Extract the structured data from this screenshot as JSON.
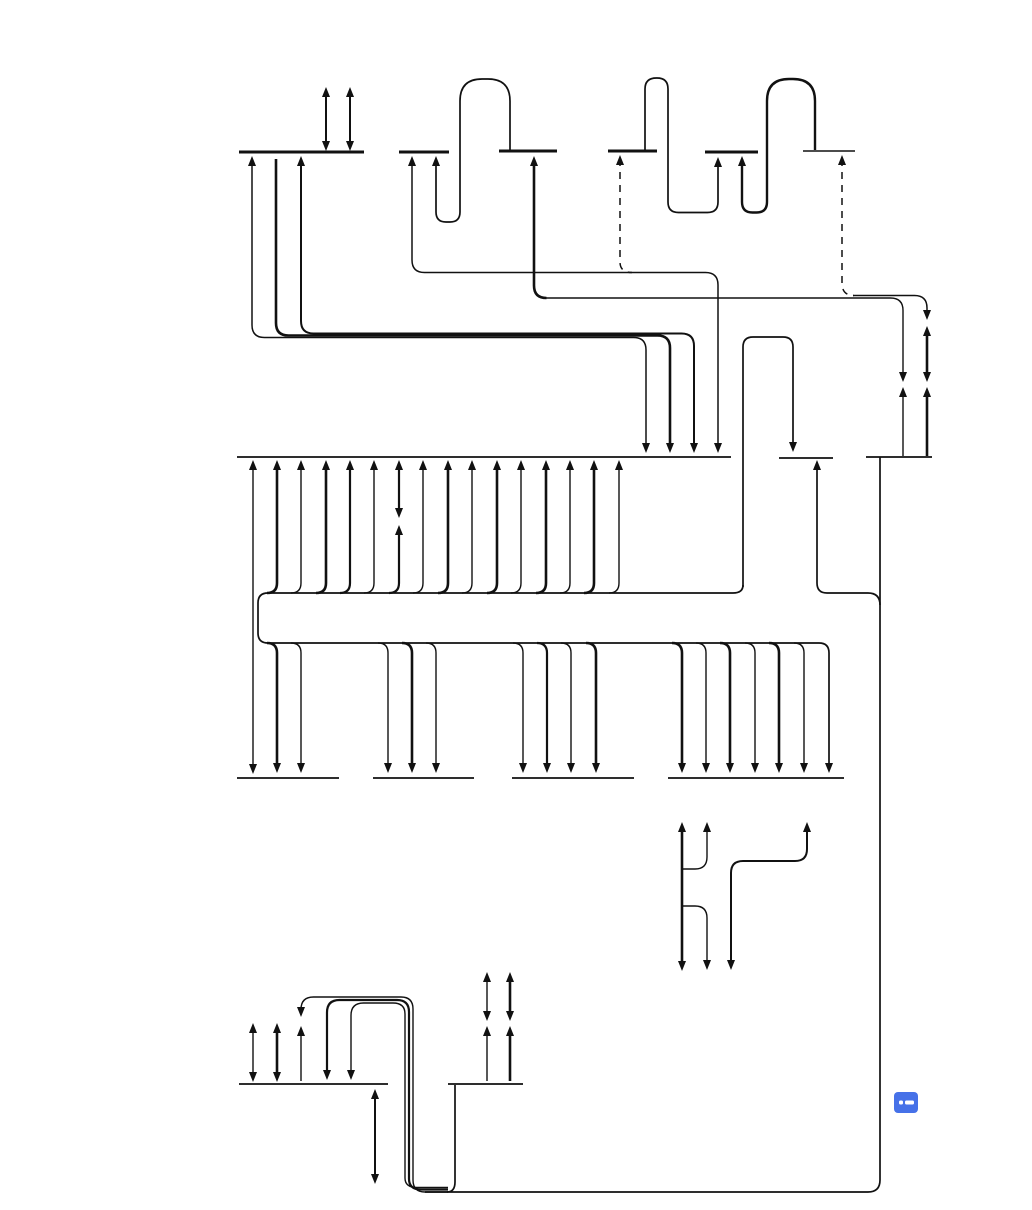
{
  "canvas": {
    "width": 1032,
    "height": 1210,
    "background": "#ffffff",
    "line_color": "#111111"
  },
  "marker_icon": {
    "name": "comment-marker-icon",
    "x": 894,
    "y": 1092,
    "width": 24,
    "height": 21,
    "radius": 4,
    "color": "#4671e8",
    "glyph_color": "#ffffff",
    "dot": {
      "x": 5,
      "y": 8.5,
      "w": 4,
      "h": 4
    },
    "dash": {
      "x": 11,
      "y": 8.5,
      "w": 9,
      "h": 4
    }
  },
  "buses": [
    {
      "id": "top-bus-a",
      "x1": 239,
      "x2": 364,
      "y": 152,
      "w": 3
    },
    {
      "id": "top-bus-b",
      "x1": 399,
      "x2": 449,
      "y": 152,
      "w": 3
    },
    {
      "id": "top-bus-b2",
      "x1": 499,
      "x2": 557,
      "y": 151,
      "w": 3
    },
    {
      "id": "top-bus-c",
      "x1": 608,
      "x2": 657,
      "y": 151,
      "w": 3
    },
    {
      "id": "top-bus-d",
      "x1": 705,
      "x2": 758,
      "y": 152,
      "w": 3
    },
    {
      "id": "top-bus-e",
      "x1": 803,
      "x2": 855,
      "y": 151,
      "w": 1.6
    },
    {
      "id": "mid-bus-1",
      "x1": 237,
      "x2": 731,
      "y": 457,
      "w": 1.7
    },
    {
      "id": "mid-bus-2",
      "x1": 779,
      "x2": 833,
      "y": 458,
      "w": 1.7
    },
    {
      "id": "mid-bus-3",
      "x1": 866,
      "x2": 932,
      "y": 457,
      "w": 1.7
    },
    {
      "id": "low-bus-1",
      "x1": 237,
      "x2": 339,
      "y": 778,
      "w": 1.7
    },
    {
      "id": "low-bus-2",
      "x1": 373,
      "x2": 474,
      "y": 778,
      "w": 1.7
    },
    {
      "id": "low-bus-3",
      "x1": 512,
      "x2": 634,
      "y": 778,
      "w": 1.7
    },
    {
      "id": "low-bus-4",
      "x1": 668,
      "x2": 844,
      "y": 778,
      "w": 1.7
    },
    {
      "id": "bottom-bus-1",
      "x1": 239,
      "x2": 388,
      "y": 1084,
      "w": 1.7
    },
    {
      "id": "bottom-bus-2",
      "x1": 448,
      "x2": 523,
      "y": 1084,
      "w": 1.7
    }
  ],
  "paths": [
    {
      "d": "M 326 96 V 143",
      "w": 2
    },
    {
      "d": "M 350 96 V 143",
      "w": 2
    },
    {
      "d": "M 252 160 V 325 Q 252 337.5 264.5 337.5 H 633.5 Q 646 337.5 646 350 V 448",
      "w": 1.5
    },
    {
      "d": "M 276 159 V 323 Q 276 335.5 288.5 335.5 H 657.5 Q 670 335.5 670 348 V 448",
      "w": 2.6
    },
    {
      "d": "M 301 160 V 321 Q 301 333.5 313.5 333.5 H 681.5 Q 694 333.5 694 346 V 448",
      "w": 2
    },
    {
      "d": "M 412 160 V 260 Q 412 272.5 424.5 272.5 H 705.5 Q 718 272.5 718 285 V 448",
      "w": 1.5
    },
    {
      "d": "M 620 159 V 262 Q 620 272.5 632 272.5",
      "w": 1.5,
      "dash": "7 6"
    },
    {
      "d": "M 534 160 V 285.5 Q 534 298 546.5 298",
      "w": 2.6
    },
    {
      "d": "M 545 298 H 890.5 Q 903 298 903 310.5 V 377",
      "w": 1.4
    },
    {
      "d": "M 903 391 V 456",
      "w": 1.4
    },
    {
      "d": "M 842 159 V 283 Q 842 295.5 854 295.5",
      "w": 1.5,
      "dash": "7 6"
    },
    {
      "d": "M 853 295.5 H 914.5 Q 927 295.5 927 308 V 314",
      "w": 1.5
    },
    {
      "d": "M 927 331 V 377",
      "w": 2.6
    },
    {
      "d": "M 927 391 V 456",
      "w": 2.6
    },
    {
      "d": "M 436 159 V 212 Q 436 222 446 222 H 450 Q 460 222 460 212 V 101 Q 460 79 482 79 H 488 Q 510 79 510 101 V 150",
      "w": 1.7
    },
    {
      "d": "M 645 151 V 89 Q 645 78 656.5 78 H 657 Q 668 78 668 89 V 202 Q 668 212.5 678.5 212.5 H 707.5 Q 718 212.5 718 202 V 161",
      "w": 1.7
    },
    {
      "d": "M 742 159 V 202 Q 742 212.5 752.5 212.5 H 756.5 Q 767 212.5 767 202 V 101 Q 767 79 789 79 H 793 Q 815 79 815 101 V 150",
      "w": 2.4
    },
    {
      "d": "M 253 463 V 771",
      "w": 1.4
    },
    {
      "d": "M 267 593 Q 277 593 277 583 V 464",
      "w": 2.6
    },
    {
      "d": "M 291 593 Q 301 593 301 583 V 464",
      "w": 1.4
    },
    {
      "d": "M 316 593 Q 326 593 326 583 V 464",
      "w": 2.6
    },
    {
      "d": "M 340 593 Q 350 593 350 583 V 464",
      "w": 2.2
    },
    {
      "d": "M 364 593 Q 374 593 374 583 V 464",
      "w": 1.4
    },
    {
      "d": "M 389 593 Q 399 593 399 583 V 529",
      "w": 2.2
    },
    {
      "d": "M 399 514 V 464",
      "w": 2.2
    },
    {
      "d": "M 413 593 Q 423 593 423 583 V 464",
      "w": 1.4
    },
    {
      "d": "M 438 593 Q 448 593 448 583 V 464",
      "w": 2.6
    },
    {
      "d": "M 462 593 Q 472 593 472 583 V 464",
      "w": 1.4
    },
    {
      "d": "M 487 593 Q 497 593 497 583 V 464",
      "w": 2.6
    },
    {
      "d": "M 511 593 Q 521 593 521 583 V 464",
      "w": 1.4
    },
    {
      "d": "M 536 593 Q 546 593 546 583 V 464",
      "w": 2.6
    },
    {
      "d": "M 560 593 Q 570 593 570 583 V 464",
      "w": 1.4
    },
    {
      "d": "M 584 593 Q 594 593 594 583 V 464",
      "w": 2.6
    },
    {
      "d": "M 609 593 Q 619 593 619 583 V 464",
      "w": 1.4
    },
    {
      "d": "M 743 585 Q 743 593 733 593 H 268 Q 258 593 258 603 V 633 Q 258 643 268 643 H 819 Q 829 643 829 653 V 766",
      "w": 1.7
    },
    {
      "d": "M 743 587 V 347 Q 743 337 753 337 H 783 Q 793 337 793 347 V 448",
      "w": 1.7
    },
    {
      "d": "M 817 463 V 583 Q 817 593 827 593 H 868 Q 880 593 880 605",
      "w": 1.7
    },
    {
      "d": "M 880 457 V 1180 Q 880 1192 868 1192 H 425",
      "w": 1.7
    },
    {
      "d": "M 267 643 Q 277 643 277 653 V 766",
      "w": 2.6
    },
    {
      "d": "M 291 643 Q 301 643 301 653 V 766",
      "w": 1.4
    },
    {
      "d": "M 378 643 Q 388 643 388 653 V 766",
      "w": 1.4
    },
    {
      "d": "M 402 643 Q 412 643 412 653 V 766",
      "w": 2.6
    },
    {
      "d": "M 426 643 Q 436 643 436 653 V 766",
      "w": 1.4
    },
    {
      "d": "M 513 643 Q 523 643 523 653 V 766",
      "w": 1.4
    },
    {
      "d": "M 537 643 Q 547 643 547 653 V 766",
      "w": 2.2
    },
    {
      "d": "M 561 643 Q 571 643 571 653 V 766",
      "w": 1.4
    },
    {
      "d": "M 586 643 Q 596 643 596 653 V 766",
      "w": 2.6
    },
    {
      "d": "M 672 643 Q 682 643 682 653 V 766",
      "w": 2.6
    },
    {
      "d": "M 696 643 Q 706 643 706 653 V 766",
      "w": 1.4
    },
    {
      "d": "M 720 643 Q 730 643 730 653 V 766",
      "w": 2.6
    },
    {
      "d": "M 745 643 Q 755 643 755 653 V 766",
      "w": 1.4
    },
    {
      "d": "M 769 643 Q 779 643 779 653 V 766",
      "w": 2.6
    },
    {
      "d": "M 794 643 Q 804 643 804 653 V 766",
      "w": 1.4
    },
    {
      "d": "M 682 826 V 967",
      "w": 2.6
    },
    {
      "d": "M 707 826 V 857 Q 707 869 695 869 H 682",
      "w": 1.4
    },
    {
      "d": "M 682 906 H 695 Q 707 906 707 918 V 964",
      "w": 1.4
    },
    {
      "d": "M 731 966 V 873 Q 731 861 743 861 H 795 Q 807 861 807 849 V 826",
      "w": 2
    },
    {
      "d": "M 253 1027 V 1078",
      "w": 1.4
    },
    {
      "d": "M 277 1027 V 1078",
      "w": 2.6
    },
    {
      "d": "M 301 1013 V 1009.5 Q 301 997 313.5 997 H 401 Q 413 997 413 1009 V 1180 Q 413 1192 425 1192 H 448",
      "w": 1.4
    },
    {
      "d": "M 327 1074 V 1012.5 Q 327 1000 339.5 1000 H 397 Q 409 1000 409 1012 V 1179 Q 409 1189.5 421 1189.5 H 448",
      "w": 2.2
    },
    {
      "d": "M 351 1074 V 1015.5 Q 351 1003 363.5 1003 H 393 Q 405 1003 405 1014 V 1178 Q 405 1187.5 417 1187.5 H 448",
      "w": 1.4
    },
    {
      "d": "M 447 1192 Q 455 1192 455 1182 V 1085",
      "w": 1.7
    },
    {
      "d": "M 375 1098 V 1179",
      "w": 2
    },
    {
      "d": "M 487 1081 V 1030",
      "w": 1.4
    },
    {
      "d": "M 487 1017 V 976",
      "w": 1.4
    },
    {
      "d": "M 510 1081 V 1030",
      "w": 2.6
    },
    {
      "d": "M 510 1017 V 976",
      "w": 2.6
    },
    {
      "d": "M 301 1081 V 1030",
      "w": 1.4
    }
  ],
  "arrowheads": [
    {
      "x": 326,
      "y": 87,
      "dir": "u"
    },
    {
      "x": 326,
      "y": 151,
      "dir": "d"
    },
    {
      "x": 350,
      "y": 87,
      "dir": "u"
    },
    {
      "x": 350,
      "y": 151,
      "dir": "d"
    },
    {
      "x": 252,
      "y": 156,
      "dir": "u"
    },
    {
      "x": 646,
      "y": 453,
      "dir": "d"
    },
    {
      "x": 670,
      "y": 453,
      "dir": "d"
    },
    {
      "x": 301,
      "y": 156,
      "dir": "u"
    },
    {
      "x": 694,
      "y": 453,
      "dir": "d"
    },
    {
      "x": 412,
      "y": 156,
      "dir": "u"
    },
    {
      "x": 718,
      "y": 453,
      "dir": "d"
    },
    {
      "x": 620,
      "y": 155,
      "dir": "u"
    },
    {
      "x": 534,
      "y": 156,
      "dir": "u"
    },
    {
      "x": 903,
      "y": 382,
      "dir": "d"
    },
    {
      "x": 903,
      "y": 387,
      "dir": "u"
    },
    {
      "x": 842,
      "y": 155,
      "dir": "u"
    },
    {
      "x": 927,
      "y": 320,
      "dir": "d"
    },
    {
      "x": 927,
      "y": 326,
      "dir": "u"
    },
    {
      "x": 927,
      "y": 382,
      "dir": "d"
    },
    {
      "x": 927,
      "y": 387,
      "dir": "u"
    },
    {
      "x": 436,
      "y": 156,
      "dir": "u"
    },
    {
      "x": 718,
      "y": 157,
      "dir": "u"
    },
    {
      "x": 742,
      "y": 156,
      "dir": "u"
    },
    {
      "x": 253,
      "y": 460,
      "dir": "u"
    },
    {
      "x": 253,
      "y": 774,
      "dir": "d"
    },
    {
      "x": 277,
      "y": 460,
      "dir": "u"
    },
    {
      "x": 301,
      "y": 460,
      "dir": "u"
    },
    {
      "x": 326,
      "y": 460,
      "dir": "u"
    },
    {
      "x": 350,
      "y": 460,
      "dir": "u"
    },
    {
      "x": 374,
      "y": 460,
      "dir": "u"
    },
    {
      "x": 399,
      "y": 460,
      "dir": "u"
    },
    {
      "x": 399,
      "y": 518,
      "dir": "d"
    },
    {
      "x": 399,
      "y": 525,
      "dir": "u"
    },
    {
      "x": 423,
      "y": 460,
      "dir": "u"
    },
    {
      "x": 448,
      "y": 460,
      "dir": "u"
    },
    {
      "x": 472,
      "y": 460,
      "dir": "u"
    },
    {
      "x": 497,
      "y": 460,
      "dir": "u"
    },
    {
      "x": 521,
      "y": 460,
      "dir": "u"
    },
    {
      "x": 546,
      "y": 460,
      "dir": "u"
    },
    {
      "x": 570,
      "y": 460,
      "dir": "u"
    },
    {
      "x": 594,
      "y": 460,
      "dir": "u"
    },
    {
      "x": 619,
      "y": 460,
      "dir": "u"
    },
    {
      "x": 793,
      "y": 452,
      "dir": "d"
    },
    {
      "x": 817,
      "y": 460,
      "dir": "u"
    },
    {
      "x": 277,
      "y": 773,
      "dir": "d"
    },
    {
      "x": 301,
      "y": 773,
      "dir": "d"
    },
    {
      "x": 388,
      "y": 773,
      "dir": "d"
    },
    {
      "x": 412,
      "y": 773,
      "dir": "d"
    },
    {
      "x": 436,
      "y": 773,
      "dir": "d"
    },
    {
      "x": 523,
      "y": 773,
      "dir": "d"
    },
    {
      "x": 547,
      "y": 773,
      "dir": "d"
    },
    {
      "x": 571,
      "y": 773,
      "dir": "d"
    },
    {
      "x": 596,
      "y": 773,
      "dir": "d"
    },
    {
      "x": 682,
      "y": 773,
      "dir": "d"
    },
    {
      "x": 706,
      "y": 773,
      "dir": "d"
    },
    {
      "x": 730,
      "y": 773,
      "dir": "d"
    },
    {
      "x": 755,
      "y": 773,
      "dir": "d"
    },
    {
      "x": 779,
      "y": 773,
      "dir": "d"
    },
    {
      "x": 804,
      "y": 773,
      "dir": "d"
    },
    {
      "x": 829,
      "y": 773,
      "dir": "d"
    },
    {
      "x": 682,
      "y": 822,
      "dir": "u"
    },
    {
      "x": 682,
      "y": 971,
      "dir": "d"
    },
    {
      "x": 707,
      "y": 822,
      "dir": "u"
    },
    {
      "x": 707,
      "y": 970,
      "dir": "d"
    },
    {
      "x": 731,
      "y": 970,
      "dir": "d"
    },
    {
      "x": 807,
      "y": 822,
      "dir": "u"
    },
    {
      "x": 253,
      "y": 1023,
      "dir": "u"
    },
    {
      "x": 253,
      "y": 1082,
      "dir": "d"
    },
    {
      "x": 277,
      "y": 1023,
      "dir": "u"
    },
    {
      "x": 277,
      "y": 1082,
      "dir": "d"
    },
    {
      "x": 301,
      "y": 1017,
      "dir": "d"
    },
    {
      "x": 301,
      "y": 1026,
      "dir": "u"
    },
    {
      "x": 327,
      "y": 1080,
      "dir": "d"
    },
    {
      "x": 351,
      "y": 1080,
      "dir": "d"
    },
    {
      "x": 375,
      "y": 1089,
      "dir": "u"
    },
    {
      "x": 375,
      "y": 1184,
      "dir": "d"
    },
    {
      "x": 487,
      "y": 1026,
      "dir": "u"
    },
    {
      "x": 487,
      "y": 1021,
      "dir": "d"
    },
    {
      "x": 487,
      "y": 972,
      "dir": "u"
    },
    {
      "x": 510,
      "y": 1026,
      "dir": "u"
    },
    {
      "x": 510,
      "y": 1021,
      "dir": "d"
    },
    {
      "x": 510,
      "y": 972,
      "dir": "u"
    }
  ]
}
